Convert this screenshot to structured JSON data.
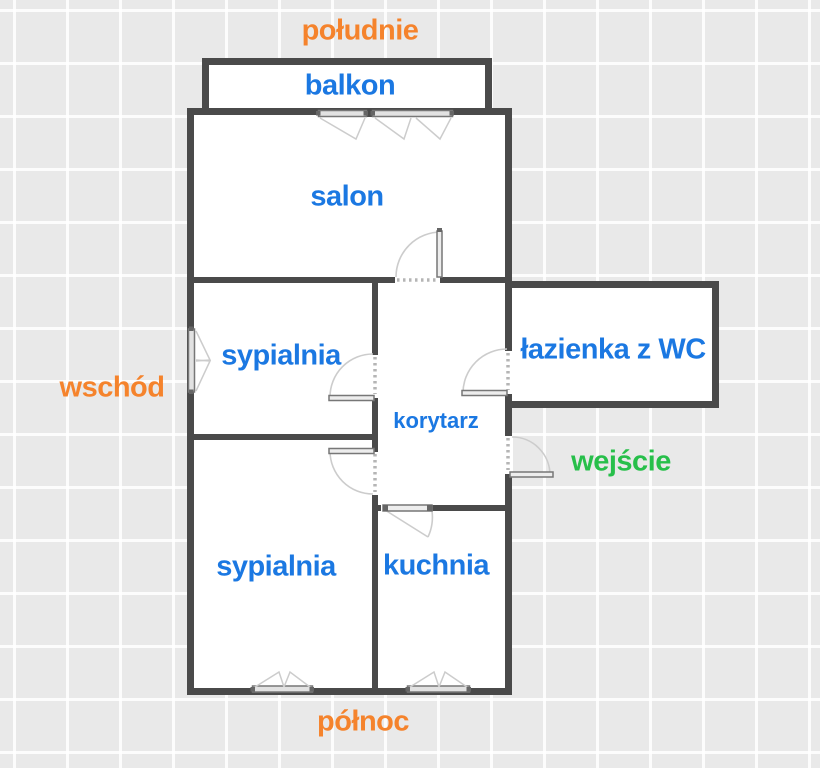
{
  "plan": {
    "type": "apartment-floor-plan",
    "labels": {
      "south": "południe",
      "balcony": "balkon",
      "living_room": "salon",
      "bedroom_upper": "sypialnia",
      "bathroom": "łazienka z WC",
      "east": "wschód",
      "corridor": "korytarz",
      "entrance": "wejście",
      "bedroom_lower": "sypialnia",
      "kitchen": "kuchnia",
      "north": "północ"
    },
    "colors": {
      "room_label": "#1b78e2",
      "compass_label": "#f5832c",
      "entrance_label": "#27bf4a",
      "wall": "#4a4a4a",
      "background": "#e9e9e9",
      "room_fill": "#ffffff",
      "swing_line": "#cccccc"
    }
  }
}
